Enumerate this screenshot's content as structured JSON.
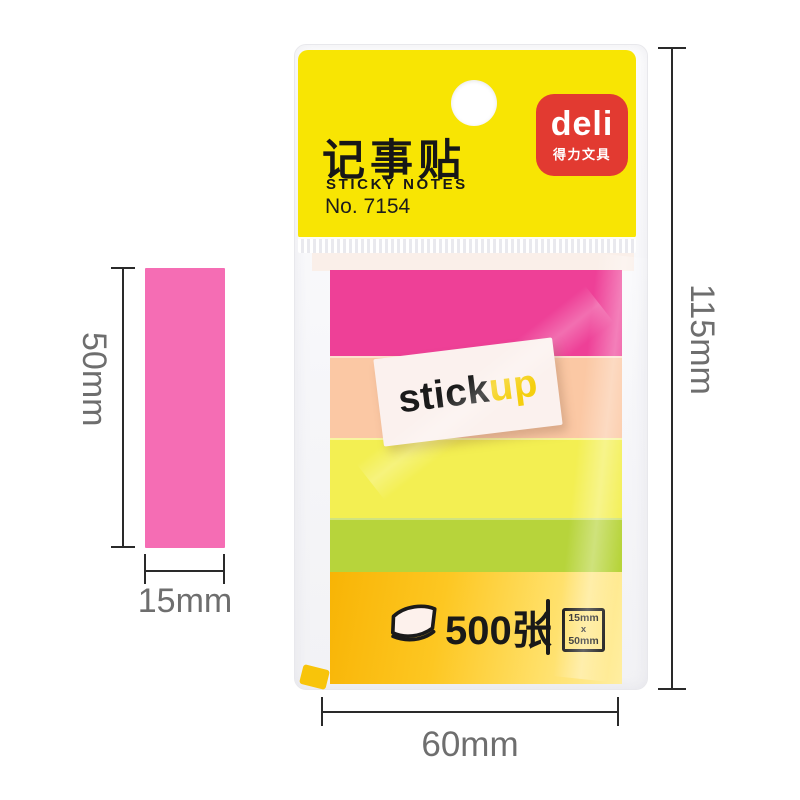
{
  "package": {
    "card": {
      "bg": "#f8e503",
      "title_cn": "记事贴",
      "title_en": "STICKY NOTES",
      "model_no": "No. 7154"
    },
    "brand": {
      "name": "deli",
      "subtext": "得力文具",
      "bg": "#e23a31",
      "text_color": "#ffffff"
    },
    "stickup_label": {
      "part1": "stick",
      "part2": "up",
      "part1_color": "#1a1a1a",
      "part2_color": "#f5cf0e",
      "bg": "#fbf1ee"
    },
    "stacks": [
      {
        "name": "magenta-notes",
        "color": "#ee4097"
      },
      {
        "name": "peach-notes",
        "color": "#fbc8a4"
      },
      {
        "name": "yellow-notes",
        "color": "#f3ef52"
      },
      {
        "name": "chartreuse-notes",
        "color": "#b7d43b"
      }
    ],
    "pad_band": {
      "color_from": "#f8b405",
      "color_to": "#ffeea1",
      "count": "500张",
      "size_box_line1": "15mm",
      "size_box_line2": "x",
      "size_box_line3": "50mm"
    }
  },
  "annotations": {
    "text_color": "#6e6e6e",
    "line_color": "#2a2a2a",
    "package_height": "115mm",
    "package_width": "60mm",
    "note_height": "50mm",
    "note_width": "15mm",
    "swatch_color": "#f56db4"
  }
}
